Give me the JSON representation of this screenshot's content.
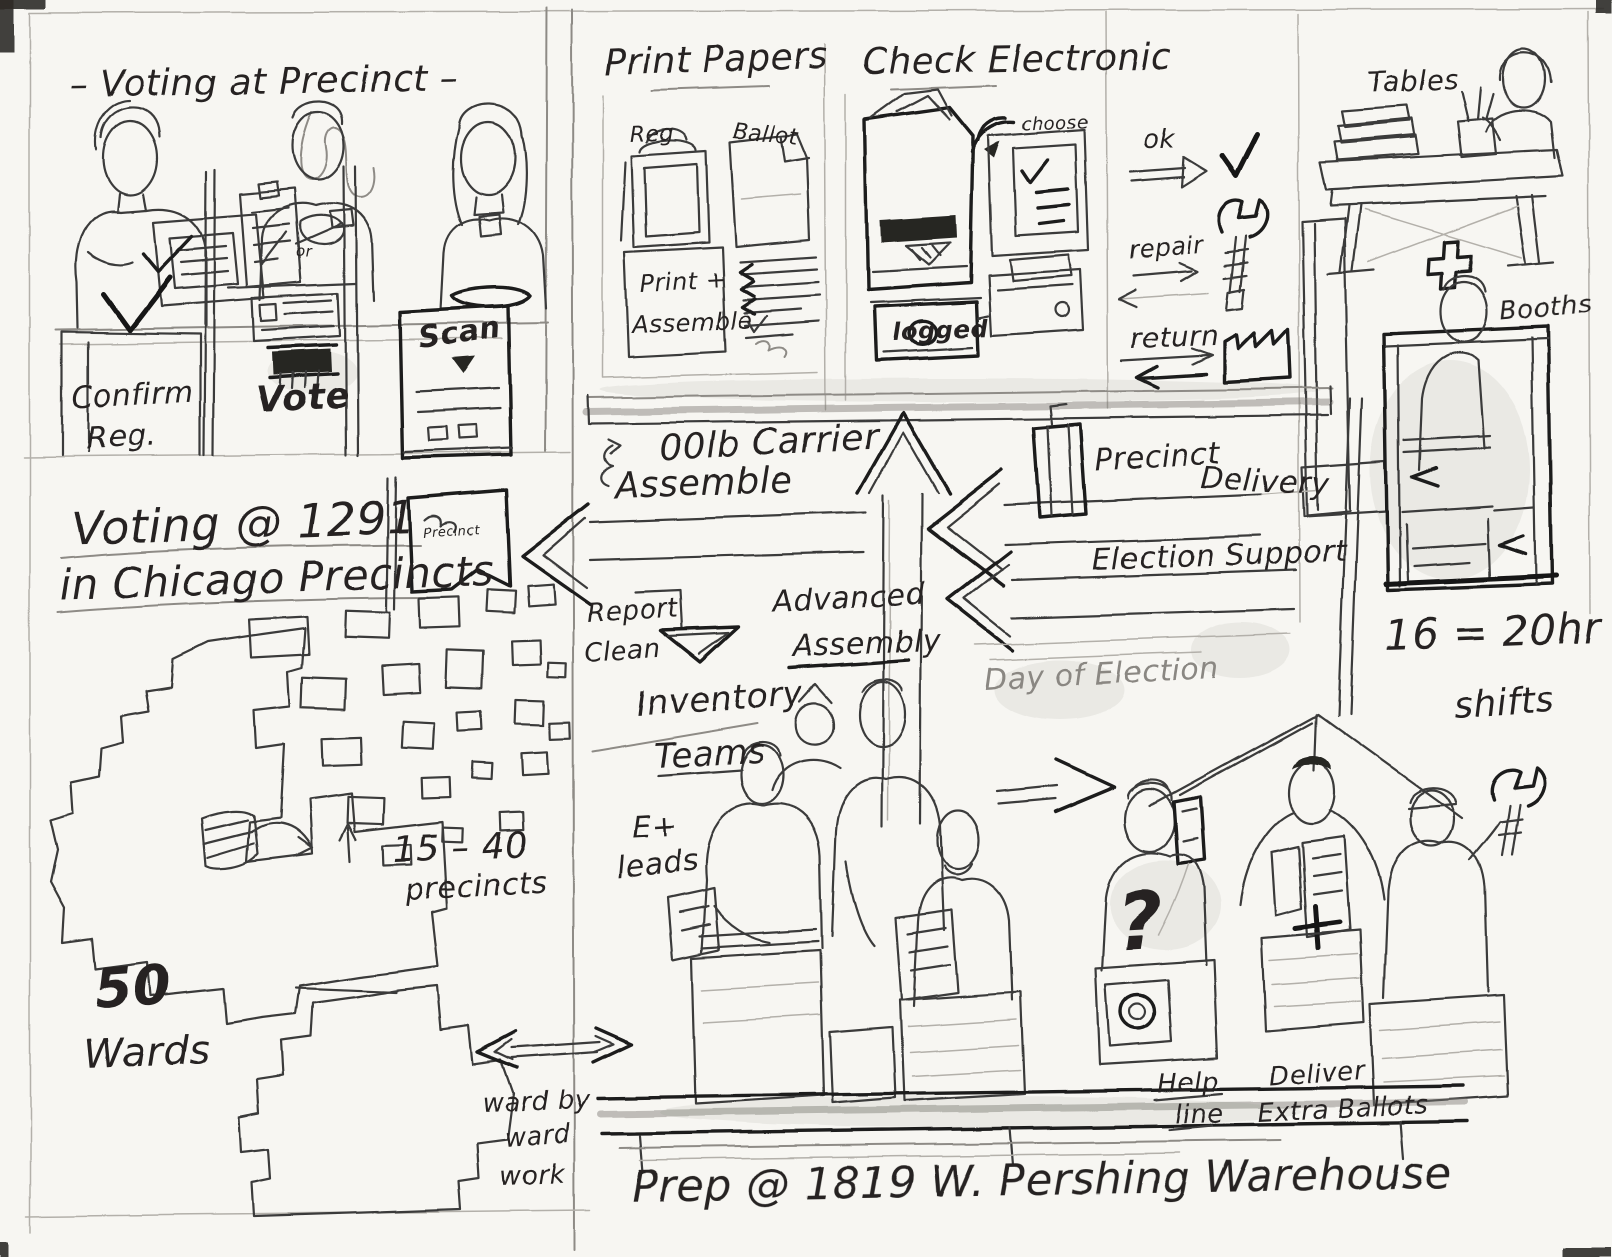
{
  "colors": {
    "paper": "#f7f6f2",
    "graphite": "#3a3a3a",
    "graphite_dark": "#1f1f1f",
    "graphite_faint": "#b3b0aa"
  },
  "icons": [
    {
      "name": "checkmark-icon",
      "meaning": "ok outcome"
    },
    {
      "name": "wrench-icon",
      "meaning": "repair outcome"
    },
    {
      "name": "warehouse-icon",
      "meaning": "return to warehouse"
    },
    {
      "name": "wifi-icon",
      "meaning": "electronic sync"
    },
    {
      "name": "plus-icon",
      "meaning": "supplies"
    },
    {
      "name": "question-mark-icon",
      "meaning": "help request"
    },
    {
      "name": "up-arrow-icon",
      "meaning": "advanced assembly flow"
    },
    {
      "name": "left-arrow-icon",
      "meaning": "delivery flow"
    }
  ],
  "voting_panel": {
    "title": "– Voting at Precinct –",
    "step1_line1": "Confirm",
    "step1_line2": "Reg.",
    "or_label": "or",
    "step2": "Vote",
    "step3": "Scan"
  },
  "print_panel": {
    "title": "Print Papers",
    "reg_label": "Reg",
    "ballot_label": "Ballot",
    "note_line1": "Print +",
    "note_line2": "Assemble"
  },
  "check_panel": {
    "title": "Check Electronic",
    "choose_label": "choose",
    "logged_label": "logged"
  },
  "outcomes": {
    "ok_label": "ok",
    "repair_label": "repair",
    "return_label": "return"
  },
  "setup_panel": {
    "tables_label": "Tables",
    "booths_label": "Booths"
  },
  "flows": {
    "carrier_line1": "00lb Carrier",
    "carrier_line2": "Assemble",
    "report_line1": "Report",
    "report_line2": "Clean",
    "advanced_line1": "Advanced",
    "advanced_line2": "Assembly",
    "precinct_delivery_line1": "Precinct",
    "precinct_delivery_line2": "Delivery",
    "election_support": "Election Support",
    "day_of_election": "Day of Election"
  },
  "city_map": {
    "heading_line1": "Voting @ 1291",
    "heading_line2": "in Chicago Precincts",
    "flag_label": "Precinct",
    "precincts_range": "15 – 40",
    "precincts_word": "precincts",
    "wards_count": "50",
    "wards_word": "Wards",
    "ward_by_ward_line1": "ward by",
    "ward_by_ward_line2": "ward",
    "ward_by_ward_line3": "work"
  },
  "warehouse": {
    "inventory_line1": "Inventory",
    "inventory_line2": "Teams",
    "leads_line1": "E+",
    "leads_line2": "leads",
    "question_mark": "?",
    "help_line1": "Help",
    "help_line2": "line",
    "deliver_line1": "Deliver",
    "deliver_line2": "Extra Ballots",
    "shifts_line1": "16 = 20hr",
    "shifts_line2": "shifts",
    "caption": "Prep @ 1819 W. Pershing Warehouse"
  }
}
